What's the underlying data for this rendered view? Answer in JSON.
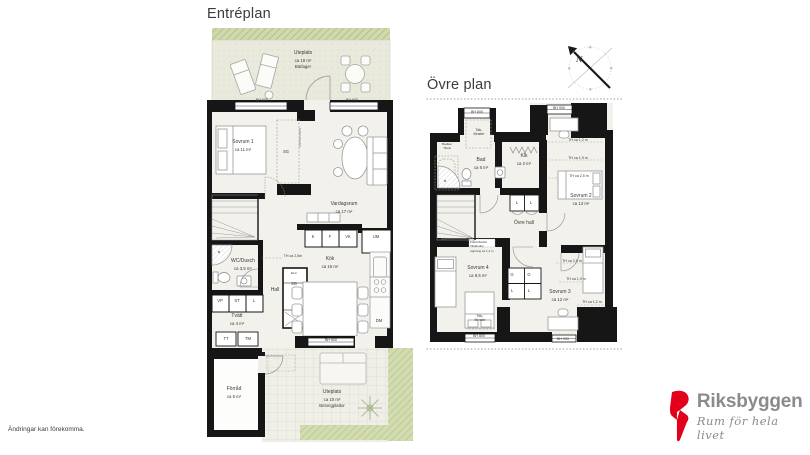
{
  "entre": {
    "title": "Entréplan",
    "uteplats_top": {
      "name": "Uteplats",
      "area": "ca 19 m²",
      "note": "Bärlager"
    },
    "sovrum1": {
      "name": "Sovrum 1",
      "area": "ca 11 m²"
    },
    "vardagsrum": {
      "name": "Vardagsrum",
      "area": "ca 17 m²"
    },
    "kok": {
      "name": "Kök",
      "area": "ca 16 m²"
    },
    "hall": {
      "name": "Hall"
    },
    "wc": {
      "name": "WC/Dusch",
      "area": "ca 3,5 m²"
    },
    "tvatt": {
      "name": "Tvätt",
      "area": "ca 4 m²"
    },
    "forrad": {
      "name": "Förråd",
      "area": "ca 5 m²"
    },
    "uteplats_bottom": {
      "name": "Uteplats",
      "area": "ca 10 m²",
      "note": "Betongplattor"
    },
    "labels": {
      "bh600": "BH 600",
      "sg": "SG",
      "k": "K",
      "f": "F",
      "vk": "VK",
      "um": "UM",
      "dm": "DM",
      "elc": "ELC",
      "vp": "VP",
      "st": "ST",
      "l": "L",
      "tt": "TT",
      "tm": "TM",
      "th25": "TH ca 2,5m",
      "vent": "Frånluftsdon"
    }
  },
  "ovre": {
    "title": "Övre plan",
    "bad": {
      "name": "Bad",
      "area": "ca 6 m²"
    },
    "klk": {
      "name": "Klk",
      "area": "ca 2 m²"
    },
    "sovrum2": {
      "name": "Sovrum 2",
      "area": "ca 13 m²"
    },
    "sovrum3": {
      "name": "Sovrum 3",
      "area": "ca 12 m²"
    },
    "sovrum4": {
      "name": "Sovrum 4",
      "area": "ca 9,5 m²"
    },
    "ovre_hall": {
      "name": "Övre hall"
    },
    "badkar": {
      "line1": "Badkar",
      "line2": "Tillval"
    },
    "vent": {
      "line1": "Frånluftsdon",
      "line2": "Tilluftsdon",
      "line3": "öppning ca 1,2 m"
    },
    "labels": {
      "bh800": "BH 800",
      "bh900": "BH 900",
      "takfonster": "Tak-fönster",
      "l": "L",
      "g": "G",
      "th12": "TH ca 1,2 m",
      "th19": "TH ca 1,9 m",
      "th25": "TH ca 2,5 m"
    }
  },
  "compass": {
    "north": "N"
  },
  "logo": {
    "brand": "Riksbyggen",
    "tagline": "Rum för hela livet"
  },
  "footer": {
    "disclaimer": "Ändringar kan förekomma."
  },
  "colors": {
    "wall": "#161616",
    "room_fill": "#f2f1ec",
    "patio_green": "#e9eadb",
    "hedge_green": "#cfd9ab",
    "grass_green": "#d2dcb0",
    "logo_red": "#e2001a",
    "logo_gray": "#8a8b8e"
  }
}
